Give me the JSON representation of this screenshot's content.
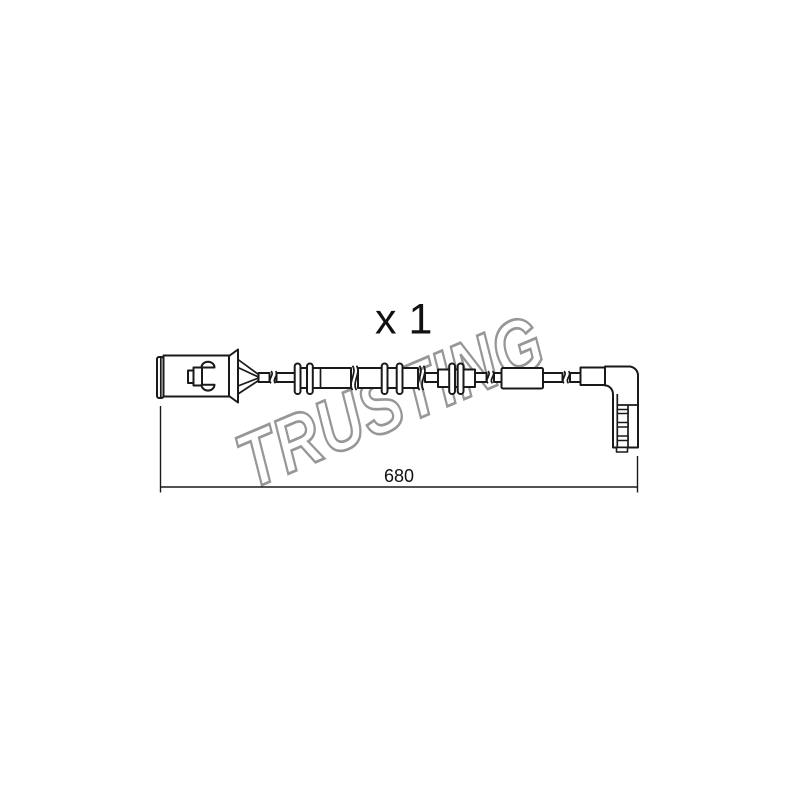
{
  "labels": {
    "quantity": "x 1",
    "dimension_mm": "680"
  },
  "watermark": {
    "text": "TRUSTING"
  },
  "colors": {
    "background": "#ffffff",
    "line": "#1a1a1a",
    "watermark_outline": "#979797",
    "watermark_fill": "#ffffff",
    "label_text": "#111111"
  },
  "diagram": {
    "type": "technical-line-drawing",
    "subject": "brake-pad-wear-sensor-cable",
    "parts": [
      "connector-plug",
      "terminal-wires",
      "cable",
      "cable-break-symbols",
      "grommet-pair-1",
      "grommet-pair-2",
      "grommet-cluster-3",
      "protective-sleeve",
      "right-angle-sensor-head",
      "length-dimension-line"
    ]
  }
}
